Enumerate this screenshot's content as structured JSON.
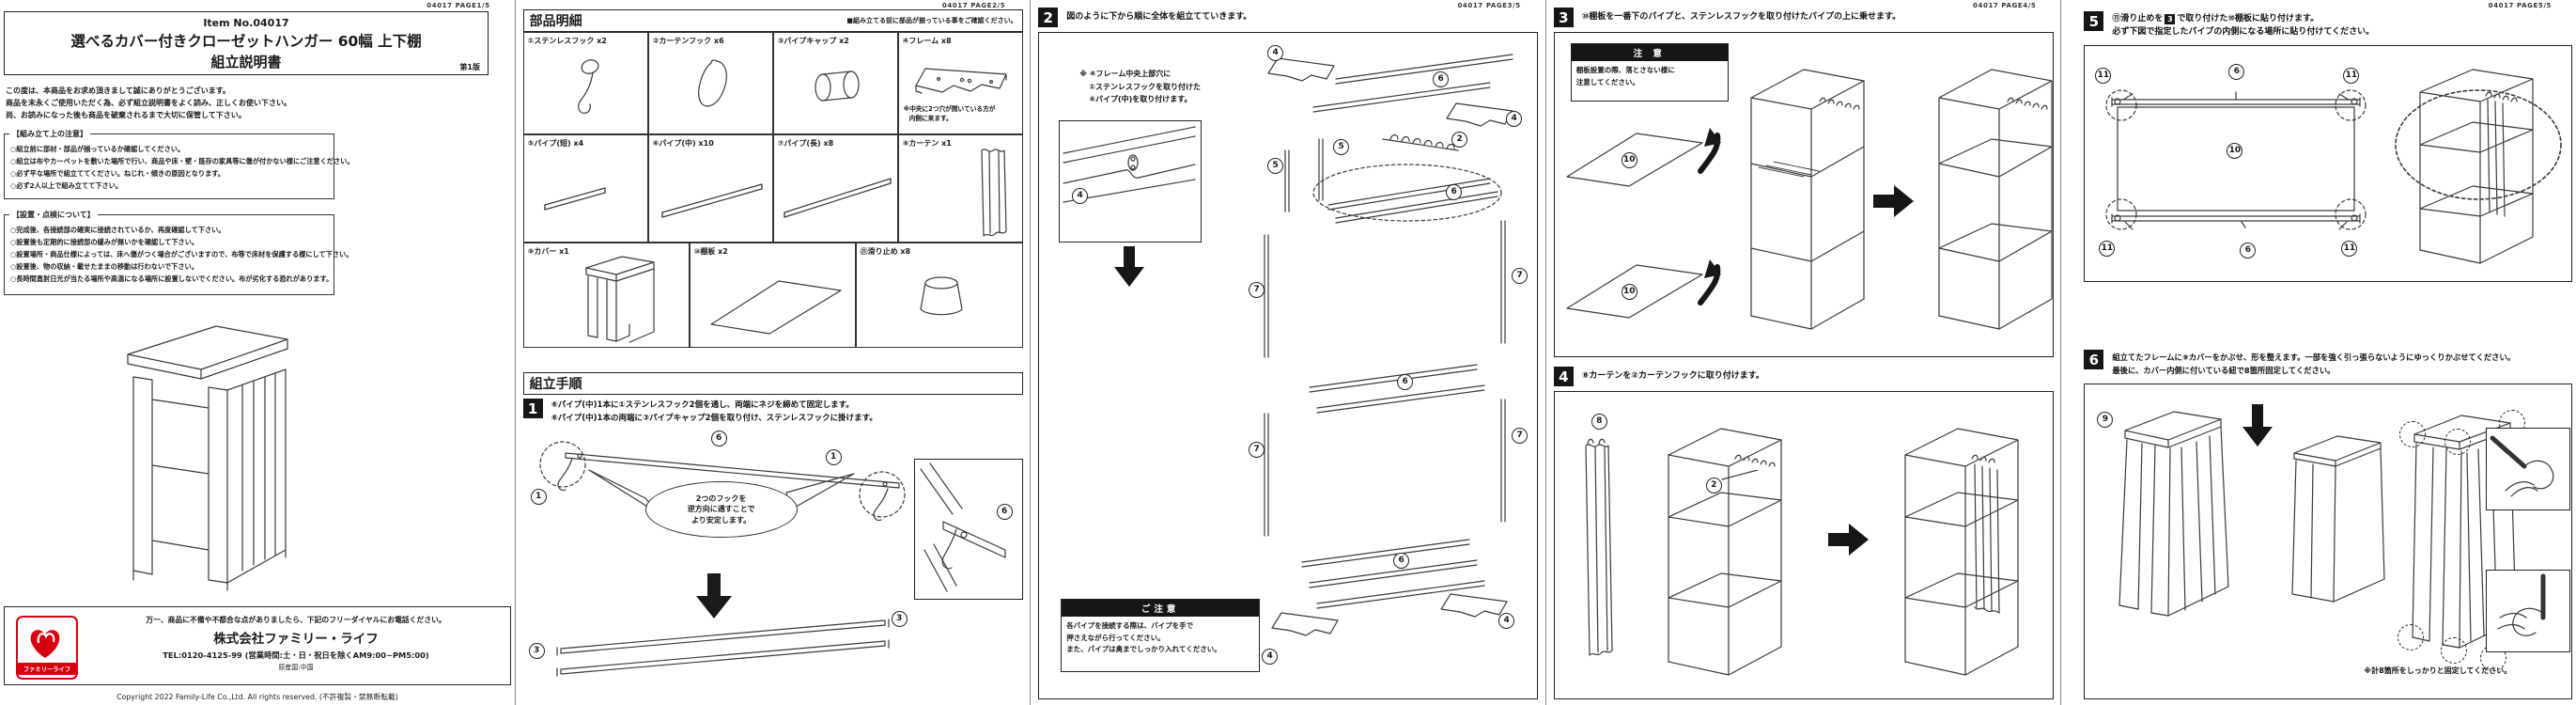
{
  "page1": {
    "header": "04017 PAGE1/5",
    "item_no": "Item No.04017",
    "title": "選べるカバー付きクローゼットハンガー  60幅  上下棚",
    "subtitle": "組立説明書",
    "edition": "第1版",
    "intro": [
      "この度は、本商品をお求め頂きまして誠にありがとうございます。",
      "商品を末永くご使用いただく為、必ず組立説明書をよく読み、正しくお使い下さい。",
      "尚、お読みになった後も商品を破棄されるまで大切に保管して下さい。"
    ],
    "assembly_notes": {
      "title": "【組み立て上の注意】",
      "items": [
        "○組立前に部材・部品が揃っているか確認してください。",
        "○組立は布やカーペットを敷いた場所で行い、商品や床・壁・既存の家具等に傷が付かない様にご注意ください。",
        "○必ず平な場所で組立ててください。ねじれ・傾きの原因となります。",
        "○必ず2人以上で組み立てて下さい。"
      ]
    },
    "placement_notes": {
      "title": "【設置・点検について】",
      "items": [
        "○完成後、各接続部の確実に接続されているか、再度確認して下さい。",
        "○設置後も定期的に接続部の緩みが無いかを確認して下さい。",
        "○設置場所・商品仕様によっては、床へ傷がつく場合がございますので、布等で床材を保護する様にして下さい。",
        "○設置後、物の収納・載せたままの移動は行わないで下さい。",
        "○長時間直射日光が当たる場所や高温になる場所に設置しないでください。布が劣化する恐れがあります。"
      ]
    },
    "support": {
      "lead": "万一、商品に不備や不都合な点がありましたら、下記のフリーダイヤルにお電話ください。",
      "company": "株式会社ファミリー・ライフ",
      "tel": "TEL:0120-4125-99 (営業時間:土・日・祝日を除くAM9:00~PM5:00)",
      "origin": "原産国:中国",
      "logo": "ファミリーライフ",
      "logo_color": "#d7000f"
    },
    "copyright": "Copyright 2022 Family-Life Co.,Ltd. All rights reserved. (不許複製・禁無断転載)"
  },
  "page2": {
    "header": "04017 PAGE2/5",
    "parts_title": "部品明細",
    "parts_note": "■組み立てる前に部品が揃っている事をご確認ください。",
    "parts": [
      {
        "label": "①ステンレスフック x2"
      },
      {
        "label": "②カーテンフック x6"
      },
      {
        "label": "③パイプキャップ x2"
      },
      {
        "label": "④フレーム x8",
        "note1": "※中央に2つ穴が開いている方が",
        "note2": "内側に来ます。"
      },
      {
        "label": "⑤パイプ(短) x4"
      },
      {
        "label": "⑥パイプ(中) x10"
      },
      {
        "label": "⑦パイプ(長) x8"
      },
      {
        "label": "⑧カーテン x1"
      },
      {
        "label": "⑨カバー x1"
      },
      {
        "label": "⑩棚板 x2"
      },
      {
        "label": "⑪滑り止め x8"
      }
    ],
    "steps_title": "組立手順",
    "step1": {
      "num": "1",
      "line1": "⑥パイプ(中)1本に①ステンレスフック2個を通し、両端にネジを締めて固定します。",
      "line2": "⑥パイプ(中)1本の両端に③パイプキャップ2個を取り付け、ステンレスフックに掛けます。",
      "bubble": [
        "2つのフックを",
        "逆方向に通すことで",
        "より安定します。"
      ],
      "labels": {
        "left_hook": "1",
        "right_hook": "1",
        "pipe": "6",
        "inset_pipe": "6",
        "cap_left": "3",
        "cap_right": "3"
      }
    }
  },
  "page3": {
    "header": "04017 PAGE3/5",
    "step2_num": "2",
    "step2_text": "図のように下から順に全体を組立てていきます。",
    "note_lines": [
      "※ ④フレーム中央上部穴に",
      "①ステンレスフックを取り付けた",
      "⑥パイプ(中)を取り付けます。"
    ],
    "caution_title": "ご注意",
    "caution_lines": [
      "各パイプを接続する際は、パイプを手で",
      "押さえながら行ってください。",
      "また、パイプは奥までしっかり入れてください。"
    ],
    "labels": [
      "4",
      "4",
      "6",
      "2",
      "4",
      "5",
      "5",
      "6",
      "7",
      "7",
      "6",
      "7",
      "7",
      "6",
      "4",
      "4"
    ]
  },
  "page4": {
    "header": "04017 PAGE4/5",
    "step3_num": "3",
    "step3_text": "⑩棚板を一番下のパイプと、ステンレスフックを取り付けたパイプの上に乗せます。",
    "caution_title": "注 意",
    "caution_lines": [
      "棚板設置の際、落とさない様に",
      "注意してください。"
    ],
    "step3_labels": [
      "10",
      "10"
    ],
    "step4_num": "4",
    "step4_text": "⑧カーテンを②カーテンフックに取り付けます。",
    "step4_labels": [
      "8",
      "2"
    ]
  },
  "page5": {
    "header": "04017 PAGE5/5",
    "step5_num": "5",
    "step5_before": "⑪滑り止めを",
    "step5_boxed": "3",
    "step5_after": "で取り付けた⑩棚板に貼り付けます。",
    "step5_line2": "必ず下図で指定したパイプの内側になる場所に貼り付けてください。",
    "step5_labels": [
      "11",
      "6",
      "11",
      "10",
      "11",
      "6",
      "11"
    ],
    "step6_num": "6",
    "step6_lines": [
      "組立てたフレームに⑨カバーをかぶせ、形を整えます。一部を強く引っ張らないようにゆっくりかぶせてください。",
      "最後に、カバー内側に付いている紐で8箇所固定してください。"
    ],
    "step6_label": "9",
    "step6_note": "※計8箇所をしっかりと固定してください。"
  }
}
